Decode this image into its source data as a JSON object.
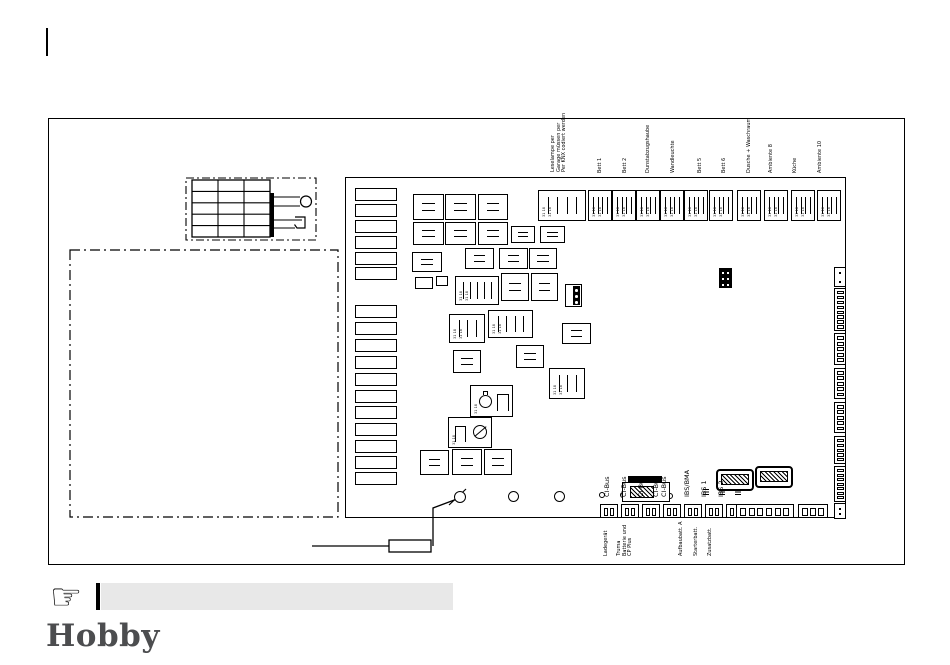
{
  "page": {
    "logo_text": "Hobby",
    "note_text": ""
  },
  "board": {
    "top_note_lines": [
      "Leselampe per",
      "Garage müssen per",
      "Per KNX codiert werden"
    ],
    "top_labels": [
      "Bett 1",
      "Bett 2",
      "Dunstabzugshaube",
      "Wandleuchte",
      "Bett 5",
      "Bett 6",
      "Dusche + Waschraum",
      "Ambiente 8",
      "Küche",
      "Ambiente 10"
    ],
    "bus_labels": [
      "CI-Bus",
      "CI-Bus",
      "CI-Bus",
      "CI-Bus",
      "CI-Bus",
      "IBS/BMA",
      "IBS 1",
      "IBS 2"
    ],
    "bottom_labels": [
      {
        "lines": [
          "Ladegerät"
        ]
      },
      {
        "lines": [
          "Truma",
          "Batterie und",
          "CP Plus"
        ]
      },
      {
        "lines": [
          "Aufbaubatt. A"
        ]
      },
      {
        "lines": [
          "Starterbatt."
        ]
      },
      {
        "lines": [
          "Zusatzbatt."
        ]
      }
    ],
    "pin_label": "31 18"
  }
}
